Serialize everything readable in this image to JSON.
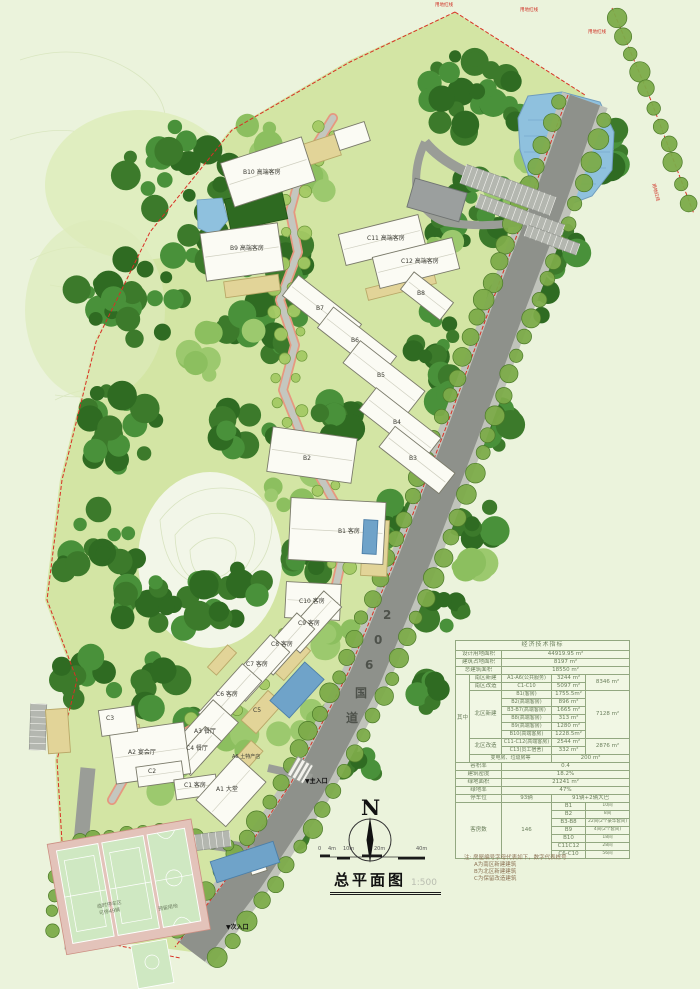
{
  "page": {
    "bg": "#ebf3dc"
  },
  "title_block": {
    "title": "总平面图",
    "scale": "1:500"
  },
  "compass": {
    "label": "N"
  },
  "scale_bar": {
    "ticks": [
      "0",
      "4m",
      "10m",
      "20m",
      "40m"
    ]
  },
  "road_label": "206国道",
  "boundary_labels": [
    "用地红线",
    "用地红线",
    "用地红线",
    "用地红线"
  ],
  "entrances": {
    "main": "▼主入口",
    "secondary": "▼次入口"
  },
  "site_labels": [
    "临时停车区",
    "可停49辆",
    "预留用地"
  ],
  "buildings": [
    "B10 高端客房",
    "B9 高端客房",
    "C11 高端客房",
    "C12 高端客房",
    "B8",
    "B7",
    "B6",
    "B5",
    "B4",
    "B3",
    "B2",
    "B1 客房",
    "C10 客房",
    "C9 客房",
    "C8 客房",
    "C7 客房",
    "C6 客房",
    "C5",
    "A3 餐厅",
    "C4 餐厅",
    "A2 宴会厅",
    "C3",
    "C2",
    "C1 客房",
    "A1 大堂",
    "A6 土特产店"
  ],
  "table": {
    "title": "经济技术指标",
    "top": [
      {
        "label": "设计用地面积",
        "value": "44919.95 m²"
      },
      {
        "label": "建筑占地面积",
        "value": "8197 m²"
      },
      {
        "label": "总建筑面积",
        "value": "18550 m²"
      }
    ],
    "among": "其中",
    "south_new": {
      "label": "南区新建",
      "item": "A1-A6(公共服务)",
      "value": "3244 m²"
    },
    "south_reno": {
      "label": "南区改造",
      "item": "C1-C10",
      "value": "5097 m²"
    },
    "south_total": "8346 m²",
    "north_new": {
      "label": "北区新建",
      "total": "7128 m²",
      "items": [
        [
          "B1(客房)",
          "1755.5m²"
        ],
        [
          "B2(高端客房)",
          "896 m²"
        ],
        [
          "B3-B7(高端客房)",
          "1665 m²"
        ],
        [
          "B8(高端客房)",
          "313 m²"
        ],
        [
          "B9(高端客房)",
          "1280 m²"
        ],
        [
          "B10(高端客房)",
          "1228.5m²"
        ]
      ]
    },
    "north_reno": {
      "label": "北区改造",
      "total": "2876 m²",
      "items": [
        [
          "C11-C12(高端客房)",
          "2544 m²"
        ],
        [
          "C13(员工宿舍)",
          "332 m²"
        ]
      ]
    },
    "utility": {
      "label": "变电房、垃圾房等",
      "value": "200 m²"
    },
    "bottom": [
      {
        "label": "容积率",
        "value": "0.4"
      },
      {
        "label": "建筑密度",
        "value": "18.2%"
      },
      {
        "label": "绿地面积",
        "value": "21241 m²"
      },
      {
        "label": "绿地率",
        "value": "47%"
      }
    ],
    "parking": {
      "label": "停车位",
      "value": "93辆",
      "detail": "91辆+2辆大巴"
    },
    "rooms": {
      "label": "客房数",
      "total": "146",
      "items": [
        [
          "B1",
          "10间"
        ],
        [
          "B2",
          "8间"
        ],
        [
          "B3-B8",
          "22间(2个豪华套间)"
        ],
        [
          "B9",
          "4间(2个套间)"
        ],
        [
          "B10",
          "18间"
        ],
        [
          "C11C12",
          "28间"
        ],
        [
          "C6-C10",
          "56间"
        ]
      ]
    }
  },
  "notes": {
    "heading": "注: 房屋编号字母代表如下，数字代表栋号",
    "a": "A为南区新建建筑",
    "b": "B为北区新建建筑",
    "c": "C为保留改造建筑"
  }
}
